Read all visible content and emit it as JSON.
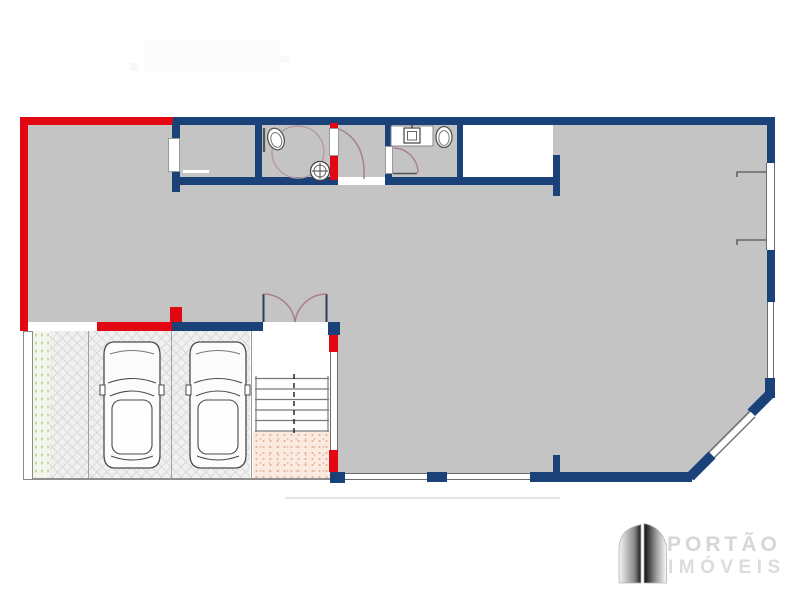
{
  "page": {
    "kind": "real-estate floor plan drawing",
    "background": "#ffffff"
  },
  "palette": {
    "wall_masonry_blue": "#1b4278",
    "wall_highlight_red": "#e30613",
    "floor_gray": "#c4c4c4",
    "paving_gray": "#f0f0f0",
    "garden_green": "#c9d6a4",
    "understair_salmon": "#e7b49e",
    "door_swing_mauve": "#a87e8f",
    "detail_line_gray": "#555555",
    "logo_text_gray": "#d6d6d6"
  },
  "logo": {
    "icon": "gate-logo-icon",
    "line1": "PORTÃO",
    "line2": "IMÓVEIS"
  },
  "plan_symbols": [
    "toilet-icon",
    "round-washbasin-icon",
    "square-washbasin-icon",
    "turning-circle-icon",
    "door-swing-icon",
    "double-door-icon",
    "staircase-icon",
    "car-top-view-icon",
    "window-symbol",
    "garden-hatch",
    "paving-hatch",
    "understair-hatch"
  ]
}
